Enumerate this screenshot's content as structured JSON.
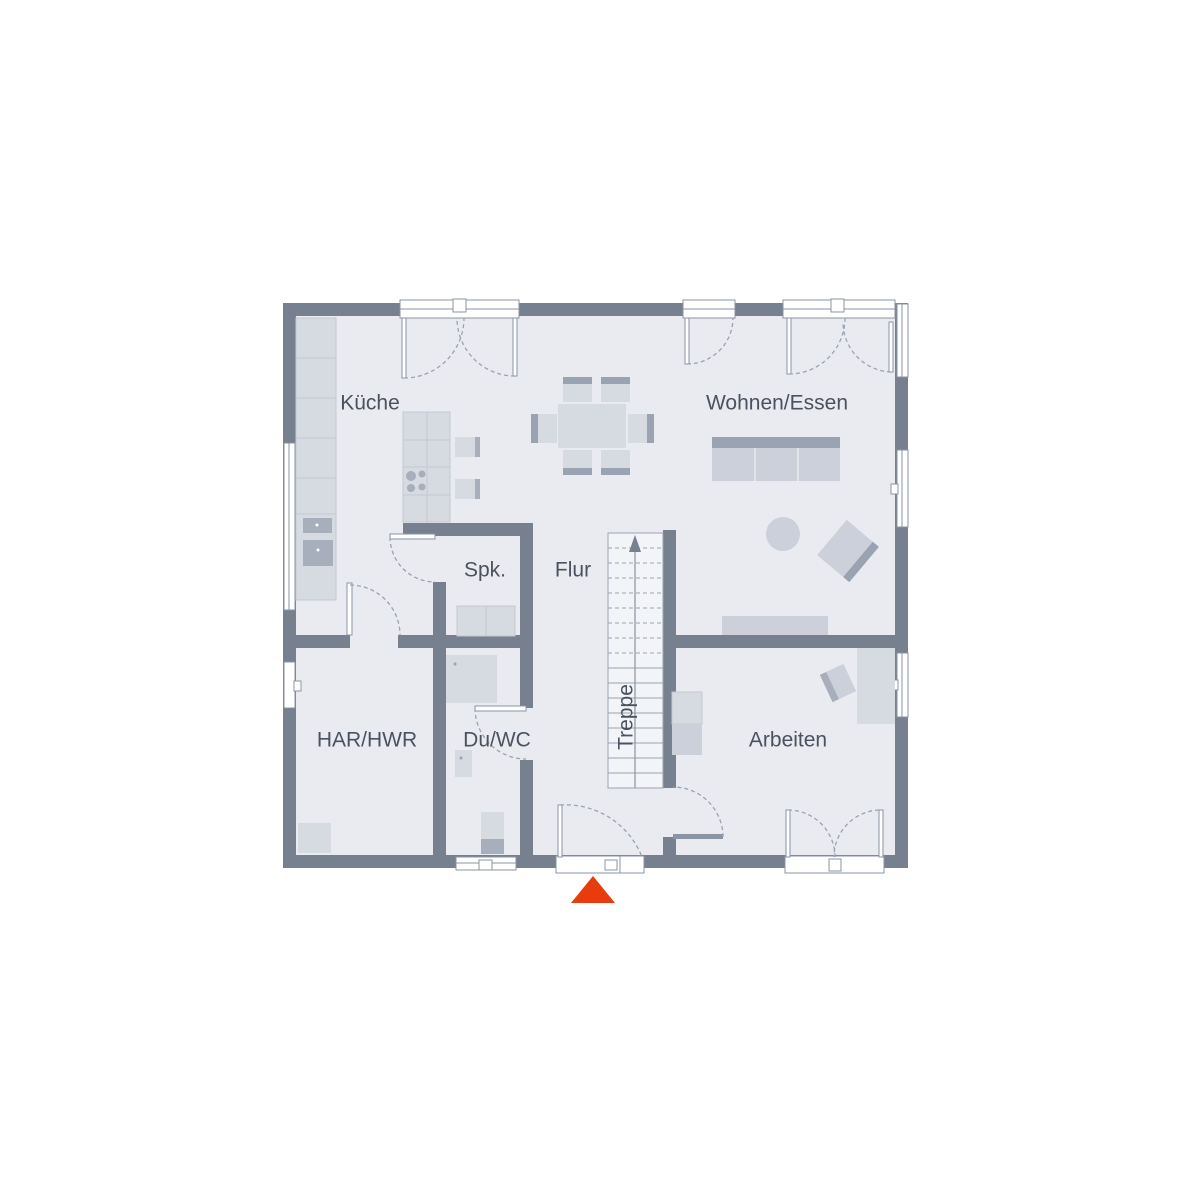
{
  "plan": {
    "type": "floor-plan",
    "rooms": {
      "kueche": {
        "label": "Küche"
      },
      "wohnen_essen": {
        "label": "Wohnen/Essen"
      },
      "spk": {
        "label": "Spk."
      },
      "flur": {
        "label": "Flur"
      },
      "treppe": {
        "label": "Treppe"
      },
      "har_hwr": {
        "label": "HAR/HWR"
      },
      "du_wc": {
        "label": "Du/WC"
      },
      "arbeiten": {
        "label": "Arbeiten"
      }
    },
    "entrance_marker": {
      "icon": "entrance-triangle",
      "direction": "up"
    },
    "stairs": {
      "direction": "up"
    }
  },
  "colors": {
    "wall": "#76808F",
    "floor": "#E9EBF0",
    "furniture_light": "#D6DAE1",
    "furniture_mid": "#CCD0DA",
    "furniture_dark": "#A7AEBC",
    "text": "#4A5261",
    "accent": "#E83C0D"
  }
}
